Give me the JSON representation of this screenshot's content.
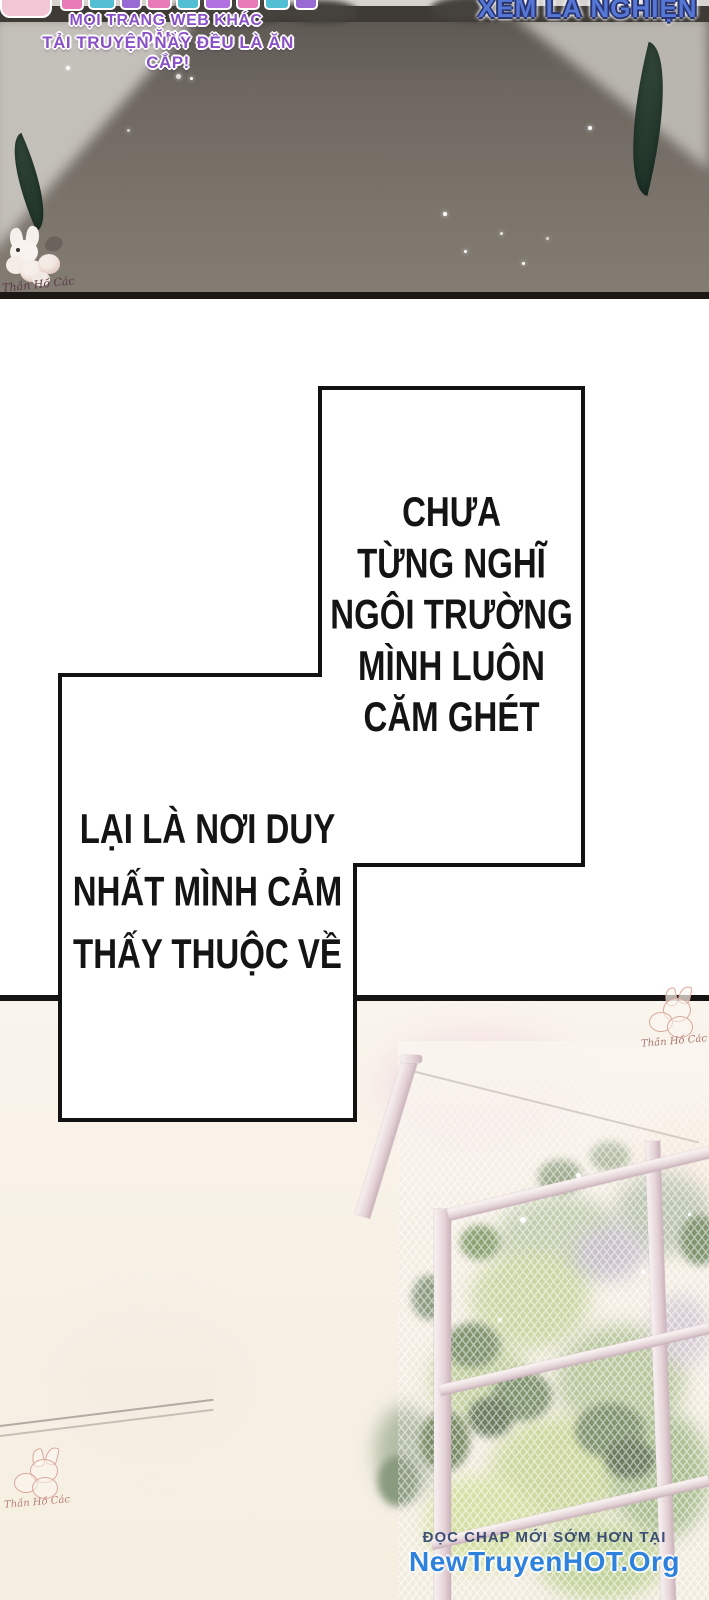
{
  "anti_piracy": {
    "line1": "MỌI TRANG WEB KHÁC ĐĂNG",
    "line2": "TẢI TRUYỆN NÀY ĐỀU LÀ ĂN CẮP!",
    "slogan": "XEM LÀ NGHIỆN"
  },
  "narration": {
    "bubble_right_lines": [
      "CHƯA",
      "TỪNG NGHĨ",
      "NGÔI TRƯỜNG",
      "MÌNH LUÔN",
      "CĂM GHÉT"
    ],
    "bubble_left_lines": [
      "LẠI LÀ NƠI DUY",
      "NHẤT MÌNH CẢM",
      "THẤY THUỘC VỀ"
    ]
  },
  "site_watermark": {
    "line1": "ĐỌC CHAP MỚI SỚM HƠN TẠI",
    "line2": "NewTruyenHOT.Org"
  },
  "scanlation_group": {
    "signature": "Thần Hồ Các"
  },
  "colors": {
    "purple_watermark": "#8a50c8",
    "slogan_blue": "#5577d6",
    "site_navy": "#1e3a6e",
    "site_blue": "#2e82dd",
    "panel_dark": "#6d6760",
    "panel_light": "#c3bfb9",
    "leaf_green": "#2f4737",
    "foliage_green": "#c2cfa0",
    "fence_pink": "#e9dbdd"
  }
}
